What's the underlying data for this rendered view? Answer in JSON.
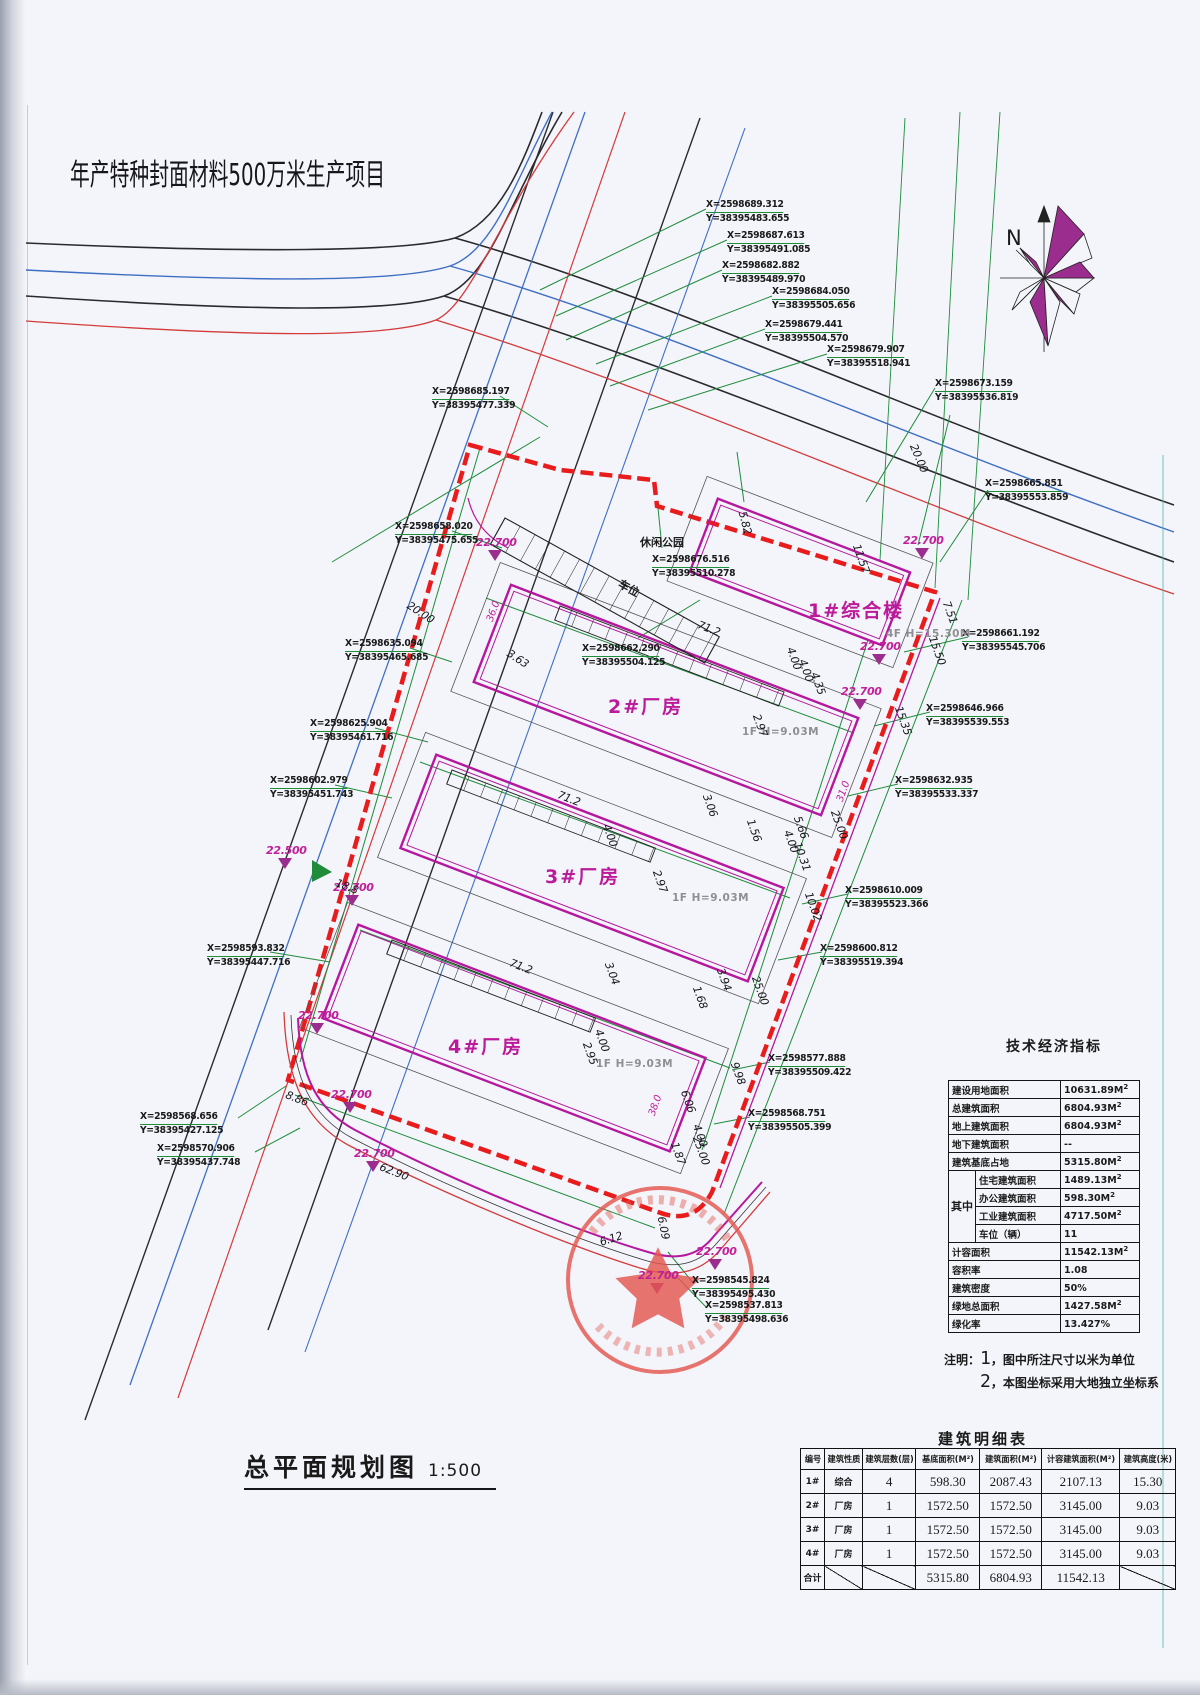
{
  "page": {
    "project_title": "年产特种封面材料500万米生产项目",
    "drawing_title": "总平面规划图",
    "drawing_scale": "1:500",
    "north_label": "N"
  },
  "site": {
    "park_label": "休闲公园",
    "parking_label": "车位",
    "buildings": [
      {
        "name": "1#综合楼",
        "spec": "4F H=15.30M"
      },
      {
        "name": "2#厂房",
        "spec": "1F H=9.03M"
      },
      {
        "name": "3#厂房",
        "spec": "1F H=9.03M"
      },
      {
        "name": "4#厂房",
        "spec": "1F H=9.03M"
      }
    ],
    "elevations": [
      "22.700",
      "22.700",
      "22.700",
      "22.700",
      "22.500",
      "22.700",
      "22.700",
      "22.700",
      "22.700",
      "22.700",
      "22.700"
    ],
    "dimensions": [
      "5.82",
      "20.00",
      "11.57",
      "7.51",
      "15.50",
      "15.35",
      "25.00",
      "10.02",
      "25.00",
      "9.98",
      "25.00",
      "4.00",
      "4.00",
      "4.35",
      "2.97",
      "71.2",
      "71.2",
      "71.2",
      "3.06",
      "1.56",
      "5.66",
      "4.00",
      "10.31",
      "2.97",
      "4.00",
      "3.04",
      "3.94",
      "1.68",
      "4.00",
      "2.95",
      "6.06",
      "4.00",
      "1.87",
      "62.90",
      "8.86",
      "6.12",
      "6.09",
      "20.00",
      "3.63",
      "18.8"
    ],
    "dimensions_magenta": [
      "36.0",
      "31.0",
      "38.0"
    ]
  },
  "coordinates": [
    {
      "x": "X=2598689.312",
      "y": "Y=38395483.655"
    },
    {
      "x": "X=2598687.613",
      "y": "Y=38395491.085"
    },
    {
      "x": "X=2598682.882",
      "y": "Y=38395489.970"
    },
    {
      "x": "X=2598684.050",
      "y": "Y=38395505.656"
    },
    {
      "x": "X=2598679.441",
      "y": "Y=38395504.570"
    },
    {
      "x": "X=2598679.907",
      "y": "Y=38395518.941"
    },
    {
      "x": "X=2598673.159",
      "y": "Y=38395536.819"
    },
    {
      "x": "X=2598665.851",
      "y": "Y=38395553.859"
    },
    {
      "x": "X=2598685.197",
      "y": "Y=38395477.339"
    },
    {
      "x": "X=2598658.020",
      "y": "Y=38395475.655"
    },
    {
      "x": "X=2598676.516",
      "y": "Y=38395510.278"
    },
    {
      "x": "X=2598662.290",
      "y": "Y=38395504.125"
    },
    {
      "x": "X=2598661.192",
      "y": "Y=38395545.706"
    },
    {
      "x": "X=2598635.094",
      "y": "Y=38395465.685"
    },
    {
      "x": "X=2598646.966",
      "y": "Y=38395539.553"
    },
    {
      "x": "X=2598625.904",
      "y": "Y=38395461.716"
    },
    {
      "x": "X=2598632.935",
      "y": "Y=38395533.337"
    },
    {
      "x": "X=2598602.979",
      "y": "Y=38395451.743"
    },
    {
      "x": "X=2598610.009",
      "y": "Y=38395523.366"
    },
    {
      "x": "X=2598600.812",
      "y": "Y=38395519.394"
    },
    {
      "x": "X=2598593.832",
      "y": "Y=38395447.716"
    },
    {
      "x": "X=2598577.888",
      "y": "Y=38395509.422"
    },
    {
      "x": "X=2598568.751",
      "y": "Y=38395505.399"
    },
    {
      "x": "X=2598568.656",
      "y": "Y=38395427.125"
    },
    {
      "x": "X=2598570.906",
      "y": "Y=38395437.748"
    },
    {
      "x": "X=2598545.824",
      "y": "Y=38395495.430"
    },
    {
      "x": "X=2598537.813",
      "y": "Y=38395498.636"
    }
  ],
  "indicator_table": {
    "title": "技术经济指标",
    "rows": [
      {
        "label": "建设用地面积",
        "value": "10631.89M",
        "sup": "2"
      },
      {
        "label": "总建筑面积",
        "value": "6804.93M",
        "sup": "2"
      },
      {
        "label": "地上建筑面积",
        "value": "6804.93M",
        "sup": "2"
      },
      {
        "label": "地下建筑面积",
        "value": "--",
        "sup": ""
      },
      {
        "label": "建筑基底占地",
        "value": "5315.80M",
        "sup": "2"
      }
    ],
    "group_label": "其中",
    "group_rows": [
      {
        "label": "住宅建筑面积",
        "value": "1489.13M",
        "sup": "2"
      },
      {
        "label": "办公建筑面积",
        "value": "598.30M",
        "sup": "2"
      },
      {
        "label": "工业建筑面积",
        "value": "4717.50M",
        "sup": "2"
      },
      {
        "label": "车位（辆）",
        "value": "11",
        "sup": ""
      }
    ],
    "rows2": [
      {
        "label": "计容面积",
        "value": "11542.13M",
        "sup": "2"
      },
      {
        "label": "容积率",
        "value": "1.08",
        "sup": ""
      },
      {
        "label": "建筑密度",
        "value": "50%",
        "sup": ""
      },
      {
        "label": "绿地总面积",
        "value": "1427.58M",
        "sup": "2"
      },
      {
        "label": "绿化率",
        "value": "13.427%",
        "sup": ""
      }
    ]
  },
  "notes": {
    "prefix": "注明：",
    "items": [
      {
        "num": "1",
        "text": "，图中所注尺寸以米为单位"
      },
      {
        "num": "2",
        "text": "，本图坐标采用大地独立坐标系"
      }
    ]
  },
  "building_table": {
    "title": "建筑明细表",
    "headers": [
      "编号",
      "建筑性质",
      "建筑层数(层)",
      "基底面积(M²)",
      "建筑面积(M²)",
      "计容建筑面积(M²)",
      "建筑高度(米)"
    ],
    "rows": [
      [
        "1#",
        "综合",
        "4",
        "598.30",
        "2087.43",
        "2107.13",
        "15.30"
      ],
      [
        "2#",
        "厂房",
        "1",
        "1572.50",
        "1572.50",
        "3145.00",
        "9.03"
      ],
      [
        "3#",
        "厂房",
        "1",
        "1572.50",
        "1572.50",
        "3145.00",
        "9.03"
      ],
      [
        "4#",
        "厂房",
        "1",
        "1572.50",
        "1572.50",
        "3145.00",
        "9.03"
      ],
      [
        "合计",
        "",
        "",
        "5315.80",
        "6804.93",
        "11542.13",
        ""
      ]
    ]
  },
  "colors": {
    "boundary_red": "#e81c1c",
    "building_magenta": "#b5179e",
    "dimension_green": "#1f8c3b",
    "road_blue": "#3f6fc4",
    "road_red": "#d43b3b",
    "stamp_red": "#e4574f",
    "compass_magenta": "#9b2d8e"
  }
}
